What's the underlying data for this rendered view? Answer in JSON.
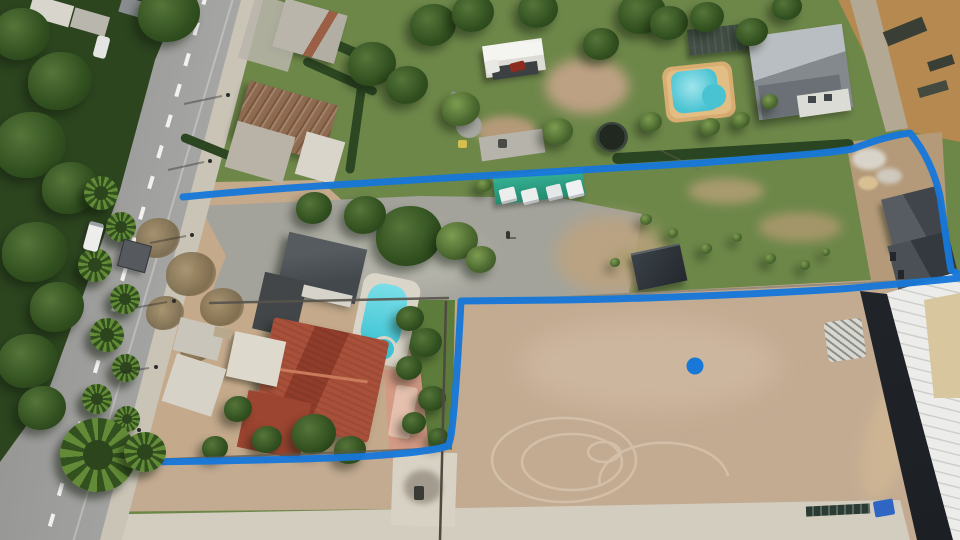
{
  "meta": {
    "type": "aerial-drone-photograph",
    "description": "Drone aerial photo of suburban land parcels: a hand-drawn blue boundary line outlines an L-shaped property containing a gravel yard, grass field, houses with pools, beside a road with palm trees; a bare dirt lot with a warehouse sits bottom-right; a blue dot marks a spot in the dirt lot.",
    "width_px": 960,
    "height_px": 540
  },
  "annotations": {
    "boundary_line": {
      "color": "#1778d8",
      "stroke_width": 7,
      "style": "hand-drawn polyline, open along road edge",
      "path_top": "M183,197 C260,189 352,184 430,179 C520,173 610,168 700,163 C770,157 825,154 852,149 C866,144 886,136 910,133 C924,150 934,170 940,196 C944,222 947,247 951,270 L960,275",
      "path_bottom": "M960,278 C920,282 880,286 840,289 C760,294 640,299 560,300 L461,301 C459,340 456,395 452,428 C451,438 450,442 448,446 C430,452 380,456 330,458 C250,461 150,462 76,463"
    },
    "marker_dot": {
      "x": 695,
      "y": 366,
      "radius": 8.5,
      "color": "#1778d8"
    }
  },
  "palette": {
    "boundary_blue": "#1778d8",
    "grass": "#6d8749",
    "dry_field": "#7e9054",
    "gravel": "#a3a39b",
    "dirt_lot": "#c3ab92",
    "yard_dirt": "#c4a98b",
    "orange_dirt": "#b5894f",
    "road_asphalt": "#a2a2a0",
    "concrete": "#d3cdc0",
    "pool_water": "#45c2d3",
    "pool_deck": "#d8ad72",
    "red_tile_roof": "#9c4532",
    "dark_roof": "#4b5054",
    "warehouse_roof": "#ececea",
    "teal_canopy": "#2ea78c",
    "forest": "#2c451f"
  },
  "scene": {
    "road": {
      "name": "two-lane asphalt road",
      "runs": "top-center to bottom-left",
      "markings": "dashed white centerline"
    },
    "ground_regions": [
      {
        "name": "forest-strip",
        "color": "#2c451f"
      },
      {
        "name": "gravel-parking-yard",
        "color": "#a3a39b"
      },
      {
        "name": "grass-field",
        "color": "#7e9054"
      },
      {
        "name": "bare-dirt-lot",
        "color": "#c3ab92"
      },
      {
        "name": "orange-dirt-corner",
        "color": "#b5894f"
      },
      {
        "name": "construction-dirt",
        "color": "#b49a79"
      },
      {
        "name": "concrete-apron",
        "color": "#d3cdc0"
      }
    ],
    "buildings": [
      {
        "name": "gray-roof-house-top-left",
        "color": "#b7b3a9"
      },
      {
        "name": "rusty-corrugated-house",
        "color": "#8d6a50"
      },
      {
        "name": "white-gable-carport",
        "color": "#f2f2ee"
      },
      {
        "name": "large-gray-hip-roof-house",
        "color": "#9aa0a4"
      },
      {
        "name": "dark-pergola",
        "color": "#434f46"
      },
      {
        "name": "house-under-construction",
        "color": "#4a5056"
      },
      {
        "name": "center-dark-roof-house",
        "color": "#4b5054"
      },
      {
        "name": "red-tile-roof-house",
        "color": "#9c4532"
      },
      {
        "name": "white-awning-sheds",
        "color": "#ded9cd"
      },
      {
        "name": "warehouse-white-roof",
        "color": "#ececea"
      }
    ],
    "pools": [
      {
        "name": "kidney-pool-north",
        "water": "#49c3d2",
        "deck": "#d8ad72"
      },
      {
        "name": "lap-pool-center",
        "water": "#3fc3d4",
        "spa": true
      }
    ],
    "objects": [
      {
        "name": "teal-canopy-with-parked-vans",
        "vans": 4
      },
      {
        "name": "trampoline"
      },
      {
        "name": "shipping-container"
      },
      {
        "name": "billboard-by-road"
      },
      {
        "name": "white-van-on-road"
      },
      {
        "name": "white-car-on-road"
      },
      {
        "name": "red-car-under-carport"
      },
      {
        "name": "materials-pile"
      },
      {
        "name": "concrete-pad-with-grill"
      },
      {
        "name": "palm-trees-row"
      },
      {
        "name": "big-palm-over-boundary"
      },
      {
        "name": "person-on-gravel"
      },
      {
        "name": "dark-solar-bar"
      },
      {
        "name": "blue-object-bottom-right"
      },
      {
        "name": "tire-track-circles"
      }
    ]
  }
}
